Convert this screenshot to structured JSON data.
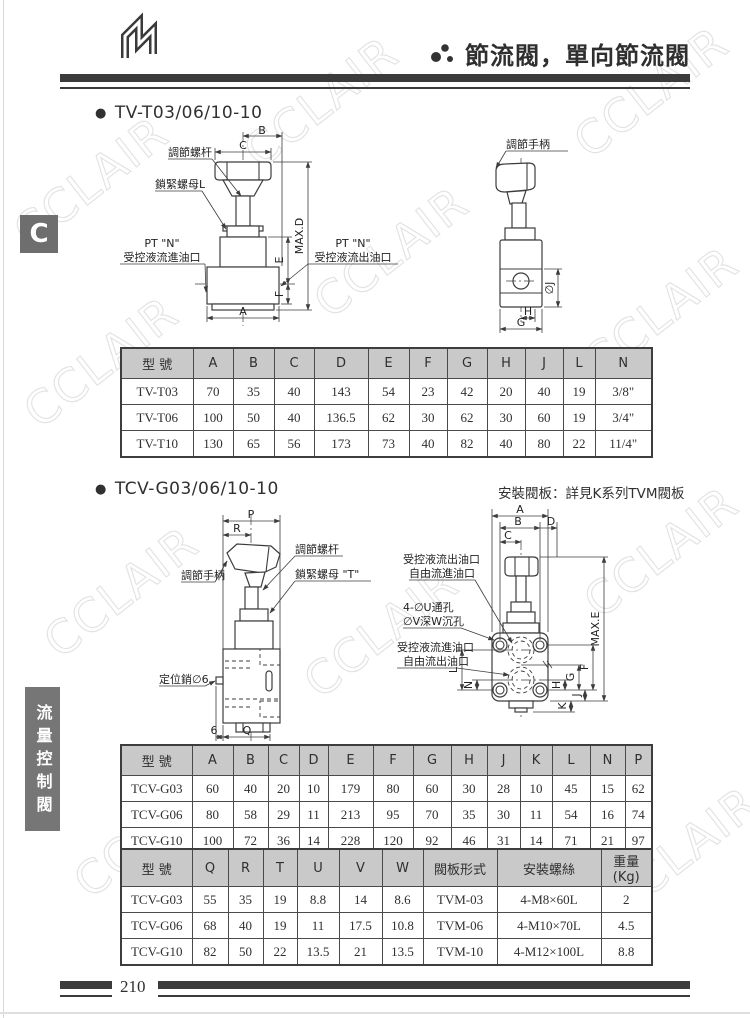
{
  "watermark": "CCLAIR",
  "header": {
    "title": "節流閥，單向節流閥"
  },
  "sidebar": {
    "tab": "C",
    "category": "流量控制閥"
  },
  "footer": {
    "page": "210"
  },
  "tv": {
    "title": "TV-T03/06/10-10",
    "front": {
      "adjust_screw": "調節螺杆",
      "lock_nut": "鎖緊螺母L",
      "port_left1": "PT \"N\"",
      "port_left2": "受控液流進油口",
      "port_right1": "PT \"N\"",
      "port_right2": "受控液流出油口",
      "dim_a": "A",
      "dim_b": "B",
      "dim_c": "C",
      "dim_d": "MAX.D",
      "dim_e": "E",
      "dim_f": "F"
    },
    "side": {
      "handle": "調節手柄",
      "dim_j": "∅J",
      "dim_h": "H",
      "dim_g": "G"
    },
    "table": {
      "headers": [
        "型 號",
        "A",
        "B",
        "C",
        "D",
        "E",
        "F",
        "G",
        "H",
        "J",
        "L",
        "N"
      ],
      "rows": [
        [
          "TV-T03",
          "70",
          "35",
          "40",
          "143",
          "54",
          "23",
          "42",
          "20",
          "40",
          "19",
          "3/8\""
        ],
        [
          "TV-T06",
          "100",
          "50",
          "40",
          "136.5",
          "62",
          "30",
          "62",
          "30",
          "60",
          "19",
          "3/4\""
        ],
        [
          "TV-T10",
          "130",
          "65",
          "56",
          "173",
          "73",
          "40",
          "82",
          "40",
          "80",
          "22",
          "11/4\""
        ]
      ]
    }
  },
  "tcv": {
    "title": "TCV-G03/06/10-10",
    "note": "安裝閥板：詳見K系列TVM閥板",
    "side": {
      "handle": "調節手柄",
      "adjust_screw": "調節螺杆",
      "lock_nut": "鎖緊螺母 \"T\"",
      "pin": "定位銷∅6",
      "dim_p": "P",
      "dim_r": "R",
      "dim_6": "6",
      "dim_q": "Q"
    },
    "plate": {
      "out1": "受控液流出油口",
      "out2": "自由流進油口",
      "hole1": "4-∅U通孔",
      "hole2": "∅V深W沉孔",
      "in1": "受控液流進油口",
      "in2": "自由流出油口",
      "dim_a": "A",
      "dim_b": "B",
      "dim_c": "C",
      "dim_d": "D",
      "dim_e": "MAX.E",
      "dim_f": "F",
      "dim_g": "G",
      "dim_h": "H",
      "dim_j": "J",
      "dim_k": "K",
      "dim_l": "L",
      "dim_n": "N"
    },
    "table_dims": {
      "headers": [
        "型 號",
        "A",
        "B",
        "C",
        "D",
        "E",
        "F",
        "G",
        "H",
        "J",
        "K",
        "L",
        "N",
        "P"
      ],
      "rows": [
        [
          "TCV-G03",
          "60",
          "40",
          "20",
          "10",
          "179",
          "80",
          "60",
          "30",
          "28",
          "10",
          "45",
          "15",
          "62"
        ],
        [
          "TCV-G06",
          "80",
          "58",
          "29",
          "11",
          "213",
          "95",
          "70",
          "35",
          "30",
          "11",
          "54",
          "16",
          "74"
        ],
        [
          "TCV-G10",
          "100",
          "72",
          "36",
          "14",
          "228",
          "120",
          "92",
          "46",
          "31",
          "14",
          "71",
          "21",
          "97"
        ]
      ]
    },
    "table_mount": {
      "headers": [
        "型 號",
        "Q",
        "R",
        "T",
        "U",
        "V",
        "W",
        "閥板形式",
        "安裝螺絲",
        "重量\n(Kg)"
      ],
      "rows": [
        [
          "TCV-G03",
          "55",
          "35",
          "19",
          "8.8",
          "14",
          "8.6",
          "TVM-03",
          "4-M8×60L",
          "2"
        ],
        [
          "TCV-G06",
          "68",
          "40",
          "19",
          "11",
          "17.5",
          "10.8",
          "TVM-06",
          "4-M10×70L",
          "4.5"
        ],
        [
          "TCV-G10",
          "82",
          "50",
          "22",
          "13.5",
          "21",
          "13.5",
          "TVM-10",
          "4-M12×100L",
          "8.8"
        ]
      ]
    }
  }
}
